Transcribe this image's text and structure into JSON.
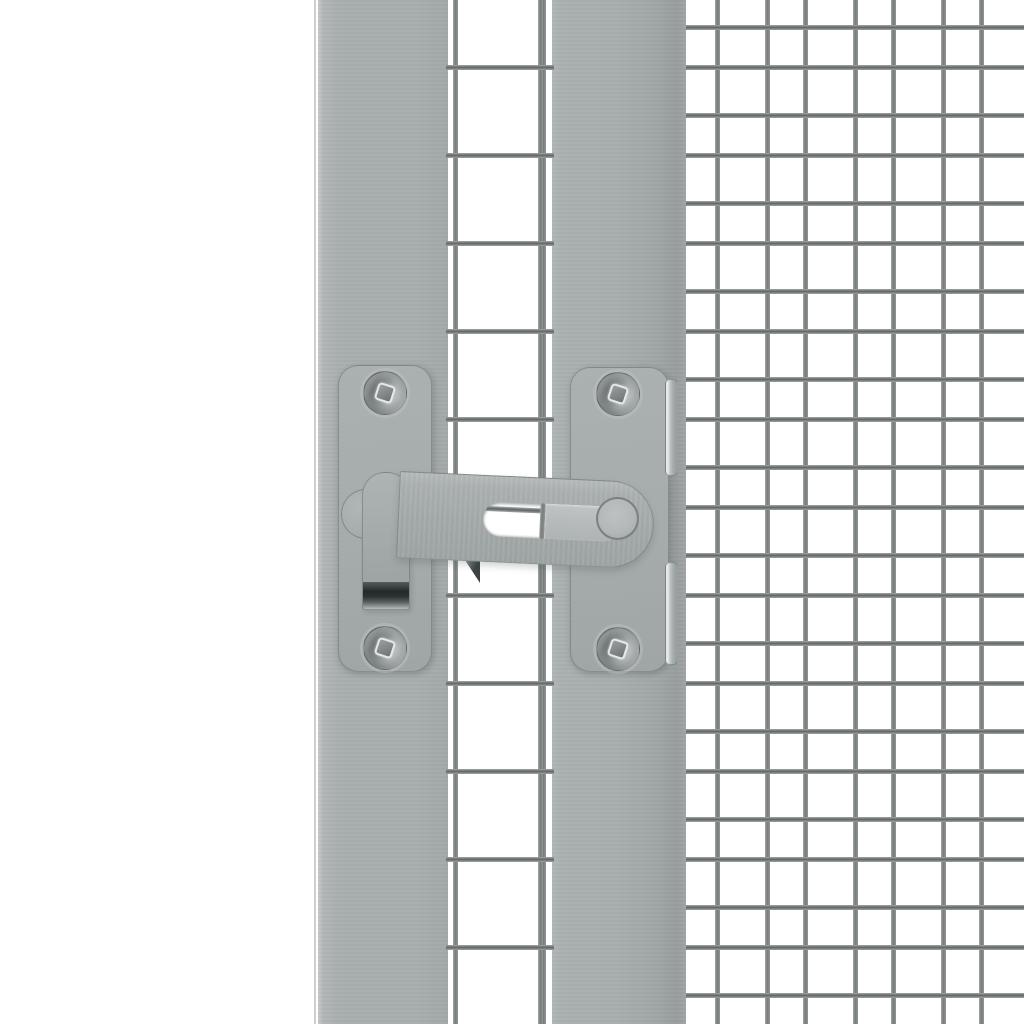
{
  "scene": {
    "subject": "Light grey steel gate latch mounted on a framed mesh door beside a fine wire-mesh panel, white background",
    "background_color": "#ffffff",
    "palette": {
      "white": "#ffffff",
      "frame_grey": "#a9aeae",
      "frame_edge_light": "#c7cbcb",
      "frame_edge_dark": "#989e9e",
      "plate_grey": "#a6acac",
      "arm_grey": "#a4aaaa",
      "arm_highlight": "#b7bbbb",
      "slide_bar_grey": "#b8bcbc",
      "stud_grey": "#b4b8b8",
      "wire_light": "#a2a8a8",
      "wire_mid": "#767c7c",
      "wire_dark": "#5f6565",
      "screw_dark": "#6b7171",
      "screw_light": "#dfe2e2",
      "handle_tip_dark": "#232929",
      "shadow_wedge": "#3c4242",
      "margin_line": "#ccd0d0",
      "tab_highlight": "#e6e9e9"
    },
    "mesh": {
      "period": 88,
      "wire_thickness": 5,
      "height": 1024,
      "gap_mesh": {
        "left": 446,
        "width": 108,
        "h_first_tops": [
          65
        ],
        "v_offsets": [
          7,
          92
        ]
      },
      "panel_mesh": {
        "left": 686,
        "width": 338,
        "h_first_tops": [
          25,
          65
        ],
        "v_offsets": [
          29,
          79
        ]
      }
    },
    "parts": [
      "left-frame-post",
      "right-frame-post",
      "door-mesh-gap",
      "wire-mesh-panel",
      "mounting-plate-left",
      "mounting-plate-right",
      "screw-head",
      "screw-drive-recess",
      "mounting-tab",
      "pivot-washer",
      "latch-handle-strap",
      "handle-grip-dark-tip",
      "latch-arm",
      "latch-slot",
      "slide-bar",
      "pivot-stud",
      "catch-shadow-wedge"
    ]
  }
}
